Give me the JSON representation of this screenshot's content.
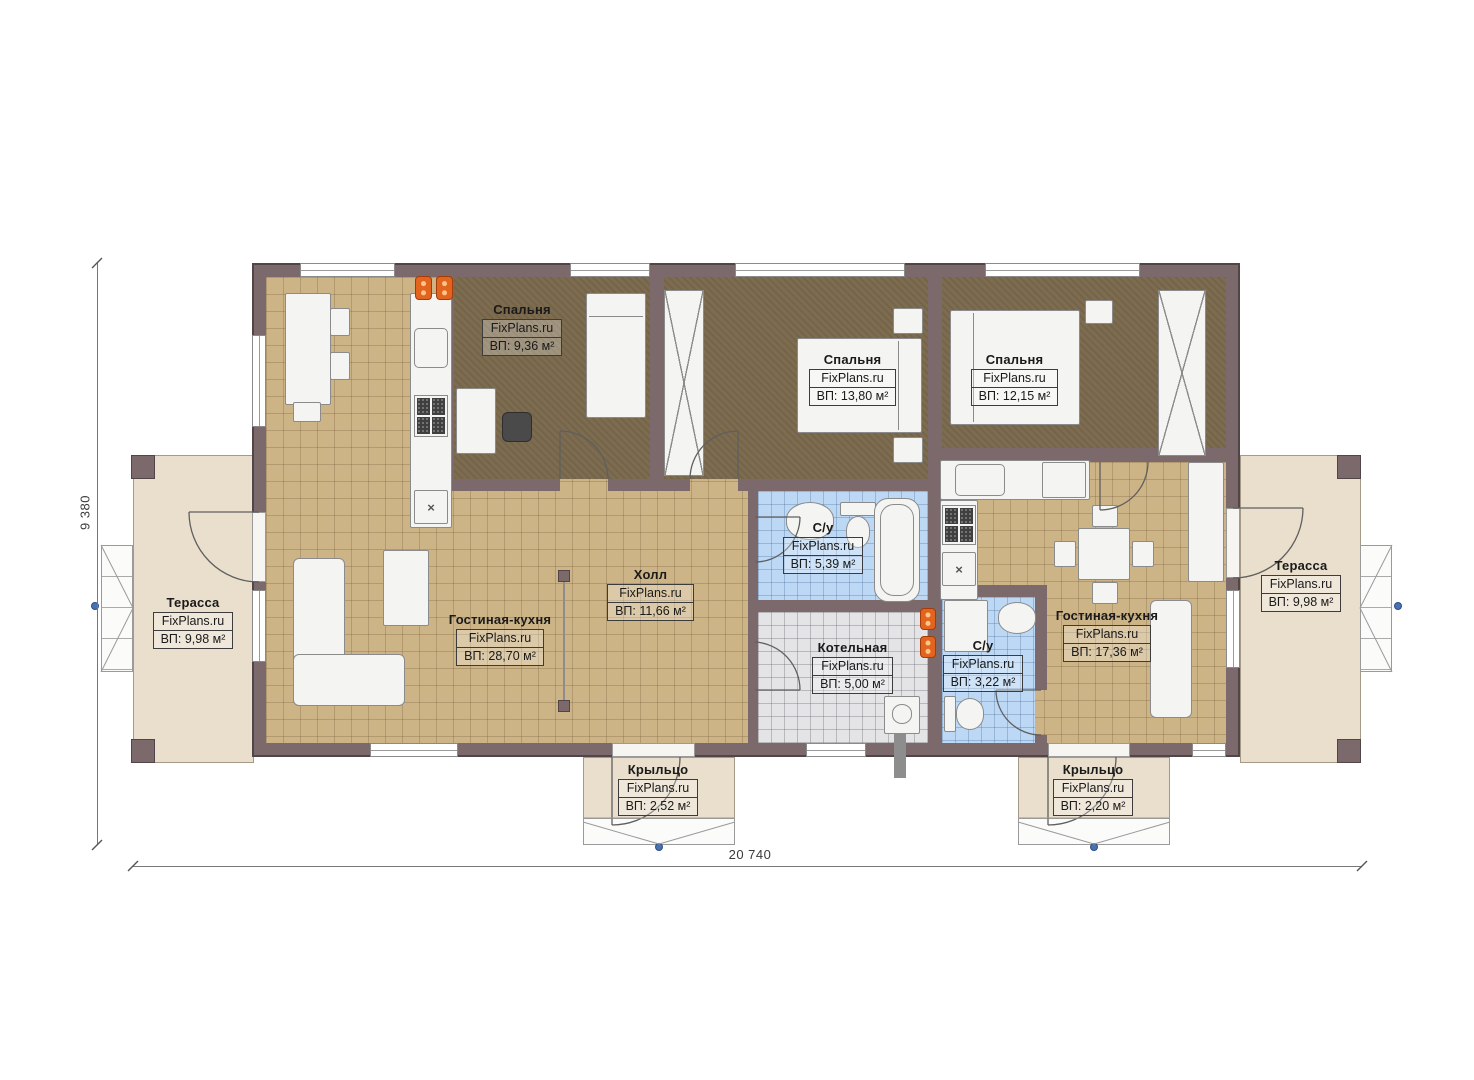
{
  "meta": {
    "brand": "FixPlans.ru"
  },
  "dims": {
    "height_label": "9 380",
    "width_label": "20 740"
  },
  "rooms": [
    {
      "id": "bedroom-1",
      "name": "Спальня",
      "area": "ВП: 9,36 м²"
    },
    {
      "id": "bedroom-2",
      "name": "Спальня",
      "area": "ВП: 13,80 м²"
    },
    {
      "id": "bedroom-3",
      "name": "Спальня",
      "area": "ВП: 12,15 м²"
    },
    {
      "id": "hall",
      "name": "Холл",
      "area": "ВП: 11,66 м²"
    },
    {
      "id": "living-left",
      "name": "Гостиная-кухня",
      "area": "ВП: 28,70 м²"
    },
    {
      "id": "living-right",
      "name": "Гостиная-кухня",
      "area": "ВП: 17,36 м²"
    },
    {
      "id": "bath-left",
      "name": "С/у",
      "area": "ВП: 5,39 м²"
    },
    {
      "id": "boiler",
      "name": "Котельная",
      "area": "ВП: 5,00 м²"
    },
    {
      "id": "bath-right",
      "name": "С/у",
      "area": "ВП: 3,22 м²"
    },
    {
      "id": "terrace-left",
      "name": "Терасса",
      "area": "ВП: 9,98 м²"
    },
    {
      "id": "terrace-right",
      "name": "Терасса",
      "area": "ВП: 9,98 м²"
    },
    {
      "id": "porch-left",
      "name": "Крыльцо",
      "area": "ВП: 2,52 м²"
    },
    {
      "id": "porch-right",
      "name": "Крыльцо",
      "area": "ВП: 2,20 м²"
    }
  ],
  "palette": {
    "wall": "#7b696b",
    "wallDark": "#524547",
    "tile": "#cdb487",
    "carpet": "#7d6c4f",
    "bath": "#bcd8f4",
    "boiler": "#e4e4e6",
    "terrace": "#e9dfcc",
    "furn": "#f4f4f2",
    "accent": "#e2641e",
    "ink": "#1a1a1a",
    "blueDot": "#4a72b0"
  }
}
